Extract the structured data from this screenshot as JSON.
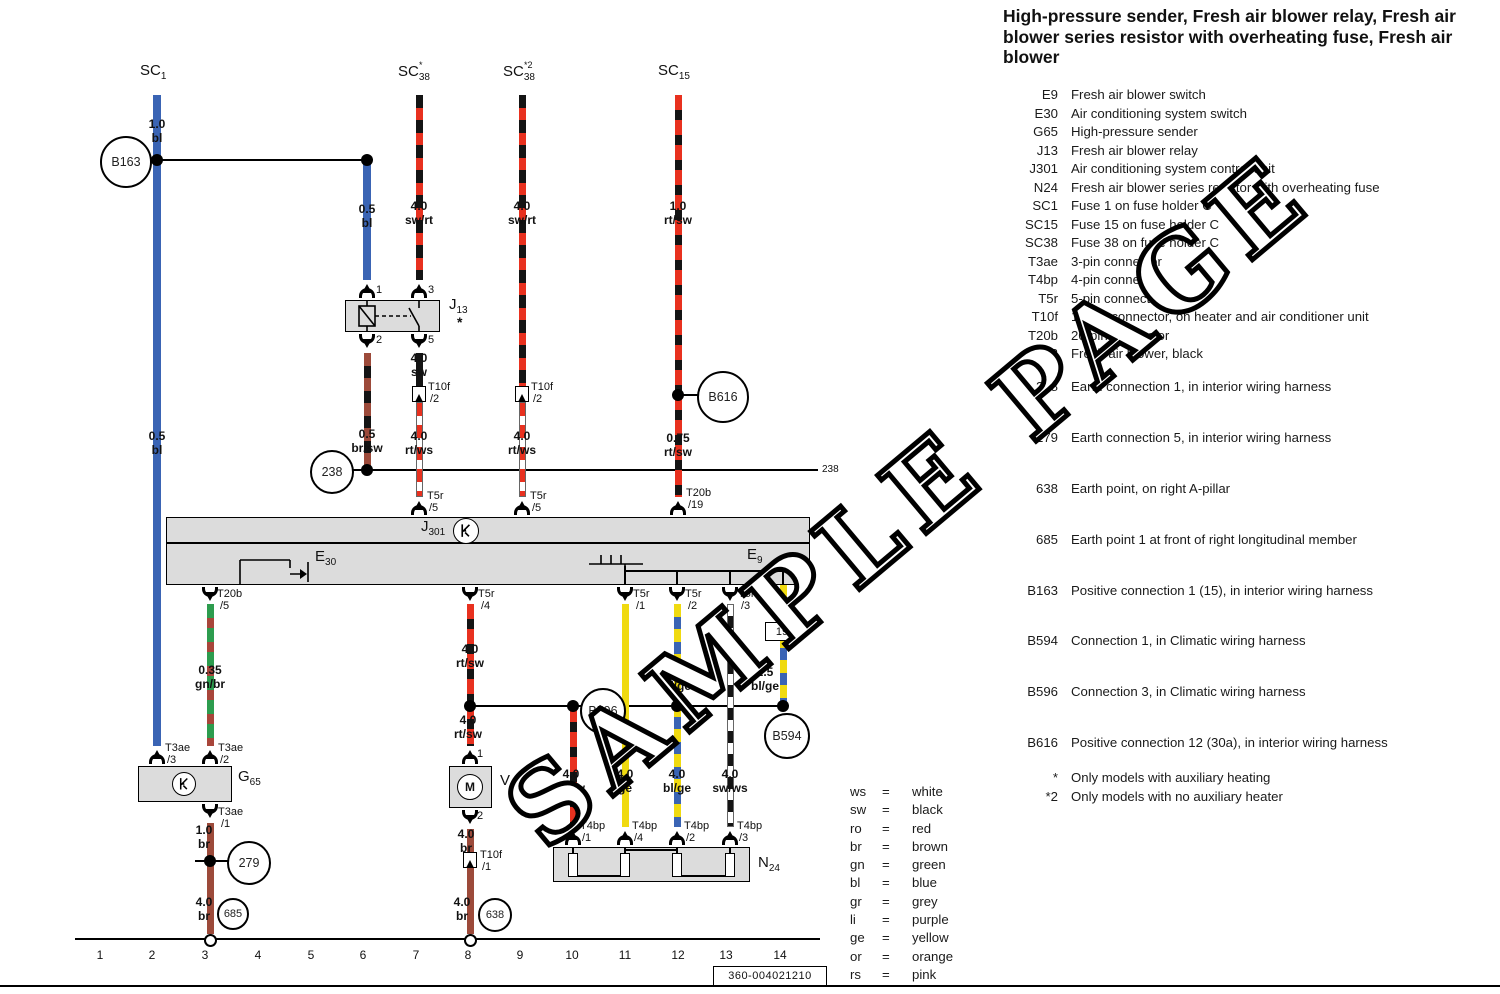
{
  "header": {
    "title": "High-pressure sender, Fresh air blower relay, Fresh air blower series resistor with overheating fuse, Fresh air blower"
  },
  "watermark": "SAMPLE PAGE",
  "footer": {
    "code": "360-004021210"
  },
  "legend": {
    "components": [
      {
        "key": "E9",
        "desc": "Fresh air blower switch"
      },
      {
        "key": "E30",
        "desc": "Air conditioning system switch"
      },
      {
        "key": "G65",
        "desc": "High-pressure sender"
      },
      {
        "key": "J13",
        "desc": "Fresh air blower relay"
      },
      {
        "key": "J301",
        "desc": "Air conditioning system control unit"
      },
      {
        "key": "N24",
        "desc": "Fresh air blower series resistor with overheating fuse"
      },
      {
        "key": "SC1",
        "desc": "Fuse 1 on fuse holder C"
      },
      {
        "key": "SC15",
        "desc": "Fuse 15 on fuse holder C"
      },
      {
        "key": "SC38",
        "desc": "Fuse 38 on fuse holder C"
      },
      {
        "key": "T3ae",
        "desc": "3-pin connector"
      },
      {
        "key": "T4bp",
        "desc": "4-pin connector"
      },
      {
        "key": "T5r",
        "desc": "5-pin connector"
      },
      {
        "key": "T10f",
        "desc": "10-pin connector, on heater and air conditioner unit"
      },
      {
        "key": "T20b",
        "desc": "20-pin connector"
      },
      {
        "key": "V2",
        "desc": "Fresh air blower, black"
      }
    ],
    "connections": [
      {
        "key": "238",
        "desc": "Earth connection 1, in interior wiring harness"
      },
      {
        "key": "279",
        "desc": "Earth connection 5, in interior wiring harness"
      },
      {
        "key": "638",
        "desc": "Earth point, on right A-pillar"
      },
      {
        "key": "685",
        "desc": "Earth point 1 at front of right longitudinal member"
      },
      {
        "key": "B163",
        "desc": "Positive connection 1 (15), in interior wiring harness"
      },
      {
        "key": "B594",
        "desc": "Connection 1, in Climatic wiring harness"
      },
      {
        "key": "B596",
        "desc": "Connection 3, in Climatic wiring harness"
      },
      {
        "key": "B616",
        "desc": "Positive connection 12 (30a), in interior wiring harness"
      }
    ],
    "notes": [
      {
        "key": "*",
        "desc": "Only models with auxiliary heating"
      },
      {
        "key": "*2",
        "desc": "Only models with no auxiliary heater"
      }
    ]
  },
  "color_codes": [
    {
      "abbr": "ws",
      "name": "white"
    },
    {
      "abbr": "sw",
      "name": "black"
    },
    {
      "abbr": "ro",
      "name": "red"
    },
    {
      "abbr": "br",
      "name": "brown"
    },
    {
      "abbr": "gn",
      "name": "green"
    },
    {
      "abbr": "bl",
      "name": "blue"
    },
    {
      "abbr": "gr",
      "name": "grey"
    },
    {
      "abbr": "li",
      "name": "purple"
    },
    {
      "abbr": "ge",
      "name": "yellow"
    },
    {
      "abbr": "or",
      "name": "orange"
    },
    {
      "abbr": "rs",
      "name": "pink"
    }
  ],
  "colors": {
    "blue": "#3a64b4",
    "red": "#e8311f",
    "black": "#141414",
    "brown": "#9c4a3a",
    "green": "#2d9c4e",
    "yellow": "#f0da10",
    "white": "#ffffff",
    "box_grey": "#dcdcdc"
  },
  "diagram": {
    "fuses": [
      {
        "x": 140,
        "y": 62,
        "main": "SC",
        "sub": "1",
        "sup": ""
      },
      {
        "x": 398,
        "y": 60,
        "main": "SC",
        "sub": "38",
        "sup": "*"
      },
      {
        "x": 503,
        "y": 60,
        "main": "SC",
        "sub": "38",
        "sup": "*2"
      },
      {
        "x": 658,
        "y": 62,
        "main": "SC",
        "sub": "15",
        "sup": ""
      }
    ],
    "component_labels": [
      {
        "x": 449,
        "y": 296,
        "main": "J",
        "sub": "13"
      },
      {
        "x": 421,
        "y": 518,
        "main": "J",
        "sub": "301"
      },
      {
        "x": 315,
        "y": 548,
        "main": "E",
        "sub": "30"
      },
      {
        "x": 747,
        "y": 546,
        "main": "E",
        "sub": "9"
      },
      {
        "x": 238,
        "y": 768,
        "main": "G",
        "sub": "65"
      },
      {
        "x": 500,
        "y": 772,
        "main": "V",
        "sub": "2"
      },
      {
        "x": 758,
        "y": 854,
        "main": "N",
        "sub": "24"
      }
    ],
    "wire_labels": [
      {
        "x": 157,
        "y": 118,
        "a": "1.0",
        "b": "bl"
      },
      {
        "x": 367,
        "y": 203,
        "a": "0.5",
        "b": "bl"
      },
      {
        "x": 419,
        "y": 200,
        "a": "4.0",
        "b": "sw/rt"
      },
      {
        "x": 522,
        "y": 200,
        "a": "4.0",
        "b": "sw/rt"
      },
      {
        "x": 678,
        "y": 200,
        "a": "1.0",
        "b": "rt/sw"
      },
      {
        "x": 157,
        "y": 430,
        "a": "0.5",
        "b": "bl"
      },
      {
        "x": 367,
        "y": 428,
        "a": "0.5",
        "b": "br/sw"
      },
      {
        "x": 419,
        "y": 352,
        "a": "4.0",
        "b": "sw"
      },
      {
        "x": 419,
        "y": 430,
        "a": "4.0",
        "b": "rt/ws"
      },
      {
        "x": 522,
        "y": 430,
        "a": "4.0",
        "b": "rt/ws"
      },
      {
        "x": 678,
        "y": 432,
        "a": "0.75",
        "b": "rt/sw"
      },
      {
        "x": 210,
        "y": 664,
        "a": "0.35",
        "b": "gn/br"
      },
      {
        "x": 470,
        "y": 643,
        "a": "4.0",
        "b": "rt/sw"
      },
      {
        "x": 468,
        "y": 714,
        "a": "4.0",
        "b": "rt/sw"
      },
      {
        "x": 677,
        "y": 666,
        "a": "4.0",
        "b": "bl/ge"
      },
      {
        "x": 765,
        "y": 666,
        "a": "2.5",
        "b": "bl/ge"
      },
      {
        "x": 466,
        "y": 828,
        "a": "4.0",
        "b": "br"
      },
      {
        "x": 571,
        "y": 768,
        "a": "4.0",
        "b": "rt/sw"
      },
      {
        "x": 625,
        "y": 768,
        "a": "4.0",
        "b": "ge"
      },
      {
        "x": 677,
        "y": 768,
        "a": "4.0",
        "b": "bl/ge"
      },
      {
        "x": 730,
        "y": 768,
        "a": "4.0",
        "b": "sw/ws"
      },
      {
        "x": 204,
        "y": 824,
        "a": "1.0",
        "b": "br"
      },
      {
        "x": 204,
        "y": 896,
        "a": "4.0",
        "b": "br"
      },
      {
        "x": 462,
        "y": 896,
        "a": "4.0",
        "b": "br"
      }
    ],
    "labels": [
      {
        "x": 427,
        "y": 490,
        "t": "T5r"
      },
      {
        "x": 429,
        "y": 502,
        "t": "/5"
      },
      {
        "x": 530,
        "y": 490,
        "t": "T5r"
      },
      {
        "x": 532,
        "y": 502,
        "t": "/5"
      },
      {
        "x": 686,
        "y": 487,
        "t": "T20b"
      },
      {
        "x": 688,
        "y": 499,
        "t": "/19"
      },
      {
        "x": 217,
        "y": 588,
        "t": "T20b"
      },
      {
        "x": 220,
        "y": 600,
        "t": "/5"
      },
      {
        "x": 478,
        "y": 588,
        "t": "T5r"
      },
      {
        "x": 481,
        "y": 600,
        "t": "/4"
      },
      {
        "x": 633,
        "y": 588,
        "t": "T5r"
      },
      {
        "x": 636,
        "y": 600,
        "t": "/1"
      },
      {
        "x": 685,
        "y": 588,
        "t": "T5r"
      },
      {
        "x": 688,
        "y": 600,
        "t": "/2"
      },
      {
        "x": 738,
        "y": 588,
        "t": "T5r"
      },
      {
        "x": 741,
        "y": 600,
        "t": "/3"
      },
      {
        "x": 428,
        "y": 381,
        "t": "T10f"
      },
      {
        "x": 430,
        "y": 393,
        "t": "/2"
      },
      {
        "x": 531,
        "y": 381,
        "t": "T10f"
      },
      {
        "x": 533,
        "y": 393,
        "t": "/2"
      },
      {
        "x": 480,
        "y": 849,
        "t": "T10f"
      },
      {
        "x": 482,
        "y": 861,
        "t": "/1"
      },
      {
        "x": 165,
        "y": 742,
        "t": "T3ae"
      },
      {
        "x": 167,
        "y": 754,
        "t": "/3"
      },
      {
        "x": 218,
        "y": 742,
        "t": "T3ae"
      },
      {
        "x": 220,
        "y": 754,
        "t": "/2"
      },
      {
        "x": 218,
        "y": 806,
        "t": "T3ae"
      },
      {
        "x": 221,
        "y": 818,
        "t": "/1"
      },
      {
        "x": 580,
        "y": 820,
        "t": "T4bp"
      },
      {
        "x": 582,
        "y": 832,
        "t": "/1"
      },
      {
        "x": 632,
        "y": 820,
        "t": "T4bp"
      },
      {
        "x": 634,
        "y": 832,
        "t": "/4"
      },
      {
        "x": 684,
        "y": 820,
        "t": "T4bp"
      },
      {
        "x": 686,
        "y": 832,
        "t": "/2"
      },
      {
        "x": 737,
        "y": 820,
        "t": "T4bp"
      },
      {
        "x": 739,
        "y": 832,
        "t": "/3"
      },
      {
        "x": 376,
        "y": 284,
        "t": "1"
      },
      {
        "x": 428,
        "y": 284,
        "t": "3"
      },
      {
        "x": 376,
        "y": 334,
        "t": "2"
      },
      {
        "x": 428,
        "y": 334,
        "t": "5"
      },
      {
        "x": 477,
        "y": 748,
        "t": "1"
      },
      {
        "x": 477,
        "y": 810,
        "t": "2"
      },
      {
        "x": 822,
        "y": 464,
        "t": "238",
        "cls": "tiny"
      },
      {
        "x": 457,
        "y": 314,
        "t": "*",
        "cls": "star"
      }
    ],
    "wires": [
      {
        "x": 157,
        "y1": 95,
        "y2": 746,
        "p": "bl"
      },
      {
        "x": 367,
        "y1": 160,
        "y2": 280,
        "p": "bl"
      },
      {
        "x": 419,
        "y1": 95,
        "y2": 280,
        "p": "swrt"
      },
      {
        "x": 522,
        "y1": 95,
        "y2": 386,
        "p": "swrt"
      },
      {
        "x": 678,
        "y1": 95,
        "y2": 497,
        "p": "rtsw"
      },
      {
        "x": 367,
        "y1": 353,
        "y2": 466,
        "p": "brsw"
      },
      {
        "x": 419,
        "y1": 353,
        "y2": 386,
        "p": "sw"
      },
      {
        "x": 419,
        "y1": 402,
        "y2": 497,
        "p": "rtws"
      },
      {
        "x": 522,
        "y1": 402,
        "y2": 497,
        "p": "rtws"
      },
      {
        "x": 210,
        "y1": 604,
        "y2": 746,
        "p": "gnbr"
      },
      {
        "x": 470,
        "y1": 604,
        "y2": 746,
        "p": "rtsw"
      },
      {
        "x": 625,
        "y1": 604,
        "y2": 827,
        "p": "ge"
      },
      {
        "x": 677,
        "y1": 604,
        "y2": 827,
        "p": "blge"
      },
      {
        "x": 730,
        "y1": 604,
        "y2": 827,
        "p": "swws"
      },
      {
        "x": 783,
        "y1": 585,
        "y2": 702,
        "p": "blge"
      },
      {
        "x": 573,
        "y1": 707,
        "y2": 827,
        "p": "rtsw"
      },
      {
        "x": 470,
        "y1": 829,
        "y2": 852,
        "p": "br"
      },
      {
        "x": 470,
        "y1": 868,
        "y2": 934,
        "p": "br"
      },
      {
        "x": 210,
        "y1": 823,
        "y2": 934,
        "p": "br"
      },
      {
        "x": 625,
        "y1": 566,
        "y2": 585,
        "p": "thin"
      },
      {
        "x": 677,
        "y1": 571,
        "y2": 585,
        "p": "thin"
      },
      {
        "x": 730,
        "y1": 571,
        "y2": 585,
        "p": "thin"
      },
      {
        "x": 783,
        "y1": 571,
        "y2": 585,
        "p": "thin"
      },
      {
        "x": 573,
        "y1": 847,
        "y2": 853,
        "p": "thin"
      },
      {
        "x": 625,
        "y1": 847,
        "y2": 853,
        "p": "thin"
      },
      {
        "x": 677,
        "y1": 847,
        "y2": 853,
        "p": "thin"
      },
      {
        "x": 730,
        "y1": 847,
        "y2": 853,
        "p": "thin"
      }
    ],
    "hlines": [
      {
        "x1": 148,
        "x2": 367,
        "y": 160
      },
      {
        "x1": 348,
        "x2": 362,
        "y": 470
      },
      {
        "x1": 367,
        "x2": 818,
        "y": 470
      },
      {
        "x1": 470,
        "x2": 783,
        "y": 706
      },
      {
        "x1": 678,
        "x2": 699,
        "y": 395
      },
      {
        "x1": 195,
        "x2": 228,
        "y": 861
      },
      {
        "x1": 625,
        "x2": 783,
        "y": 571,
        "h": 1.5
      },
      {
        "x1": 166,
        "x2": 810,
        "y": 543,
        "h": 1.5
      },
      {
        "x1": 573,
        "x2": 625,
        "y": 876,
        "h": 1.5
      },
      {
        "x1": 625,
        "x2": 677,
        "y": 850,
        "h": 1.5
      },
      {
        "x1": 677,
        "x2": 730,
        "y": 876,
        "h": 1.5
      },
      {
        "x1": 75,
        "x2": 820,
        "y": 939,
        "h": 2.5
      },
      {
        "x1": 0,
        "x2": 1500,
        "y": 986,
        "h": 2.5
      }
    ],
    "boxes": [
      {
        "x": 345,
        "y": 300,
        "w": 95,
        "h": 32,
        "name": "J13"
      },
      {
        "x": 166,
        "y": 517,
        "w": 644,
        "h": 68,
        "name": "J301"
      },
      {
        "x": 138,
        "y": 766,
        "w": 94,
        "h": 36,
        "name": "G65"
      },
      {
        "x": 449,
        "y": 766,
        "w": 43,
        "h": 42,
        "name": "V2"
      },
      {
        "x": 553,
        "y": 847,
        "w": 197,
        "h": 35,
        "name": "N24"
      }
    ],
    "resistors": [
      {
        "x": 573
      },
      {
        "x": 625
      },
      {
        "x": 677
      },
      {
        "x": 730
      }
    ],
    "circles": [
      {
        "x": 124,
        "y": 160,
        "r": 24,
        "label": "B163"
      },
      {
        "x": 330,
        "y": 470,
        "r": 20,
        "label": "238"
      },
      {
        "x": 721,
        "y": 395,
        "r": 24,
        "label": "B616"
      },
      {
        "x": 601,
        "y": 709,
        "r": 21,
        "label": "B596"
      },
      {
        "x": 785,
        "y": 734,
        "r": 21,
        "label": "B594"
      },
      {
        "x": 247,
        "y": 861,
        "r": 20,
        "label": "279"
      },
      {
        "x": 231,
        "y": 912,
        "r": 14,
        "label": "685"
      },
      {
        "x": 493,
        "y": 913,
        "r": 15,
        "label": "638"
      }
    ],
    "sym_circles": [
      {
        "x": 466,
        "y": 531,
        "r": 13,
        "type": "k"
      },
      {
        "x": 184,
        "y": 784,
        "r": 12,
        "type": "k"
      },
      {
        "x": 470,
        "y": 787,
        "r": 13,
        "type": "m"
      }
    ],
    "dots": [
      {
        "x": 157,
        "y": 160
      },
      {
        "x": 367,
        "y": 160
      },
      {
        "x": 367,
        "y": 470
      },
      {
        "x": 678,
        "y": 395
      },
      {
        "x": 470,
        "y": 706
      },
      {
        "x": 573,
        "y": 706
      },
      {
        "x": 677,
        "y": 706
      },
      {
        "x": 783,
        "y": 706
      },
      {
        "x": 210,
        "y": 861
      }
    ],
    "conns": [
      {
        "x": 367,
        "y": 300,
        "s": "top"
      },
      {
        "x": 419,
        "y": 300,
        "s": "top"
      },
      {
        "x": 367,
        "y": 332,
        "s": "bot"
      },
      {
        "x": 419,
        "y": 332,
        "s": "bot"
      },
      {
        "x": 419,
        "y": 517,
        "s": "top"
      },
      {
        "x": 522,
        "y": 517,
        "s": "top"
      },
      {
        "x": 678,
        "y": 517,
        "s": "top"
      },
      {
        "x": 210,
        "y": 585,
        "s": "bot"
      },
      {
        "x": 470,
        "y": 585,
        "s": "bot"
      },
      {
        "x": 625,
        "y": 585,
        "s": "bot"
      },
      {
        "x": 677,
        "y": 585,
        "s": "bot"
      },
      {
        "x": 730,
        "y": 585,
        "s": "bot"
      },
      {
        "x": 157,
        "y": 766,
        "s": "top"
      },
      {
        "x": 210,
        "y": 766,
        "s": "top"
      },
      {
        "x": 210,
        "y": 802,
        "s": "bot"
      },
      {
        "x": 470,
        "y": 766,
        "s": "top"
      },
      {
        "x": 470,
        "y": 808,
        "s": "bot"
      },
      {
        "x": 573,
        "y": 847,
        "s": "top"
      },
      {
        "x": 625,
        "y": 847,
        "s": "top"
      },
      {
        "x": 677,
        "y": 847,
        "s": "top"
      },
      {
        "x": 730,
        "y": 847,
        "s": "top"
      }
    ],
    "t10f_boxes": [
      {
        "x": 419,
        "y": 386
      },
      {
        "x": 522,
        "y": 386
      },
      {
        "x": 470,
        "y": 852
      }
    ],
    "ref_boxes": [
      {
        "x": 765,
        "y": 622,
        "w": 32,
        "h": 17,
        "t": "19"
      }
    ],
    "earth_points": [
      {
        "x": 210,
        "y": 940
      },
      {
        "x": 470,
        "y": 940
      }
    ],
    "tracks": [
      {
        "n": "1",
        "x": 100
      },
      {
        "n": "2",
        "x": 152
      },
      {
        "n": "3",
        "x": 205
      },
      {
        "n": "4",
        "x": 258
      },
      {
        "n": "5",
        "x": 311
      },
      {
        "n": "6",
        "x": 363
      },
      {
        "n": "7",
        "x": 416
      },
      {
        "n": "8",
        "x": 468
      },
      {
        "n": "9",
        "x": 520
      },
      {
        "n": "10",
        "x": 572
      },
      {
        "n": "11",
        "x": 625
      },
      {
        "n": "12",
        "x": 678
      },
      {
        "n": "13",
        "x": 726
      },
      {
        "n": "14",
        "x": 780
      }
    ],
    "track_y": 948
  }
}
